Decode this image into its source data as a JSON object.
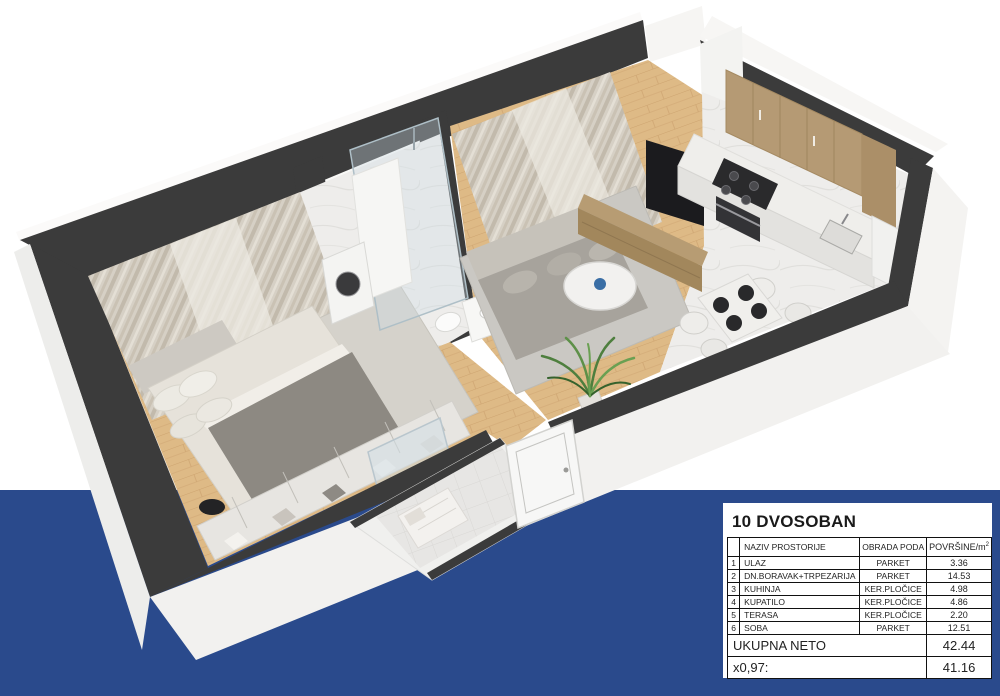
{
  "palette": {
    "background": "#ffffff",
    "band_blue": "#2a4a8c",
    "wall_dark": "#3b3b3b",
    "wood_floor": "#deba86",
    "marble_floor": "#eeedeb",
    "curtain_beige": "#d6d0c5",
    "plant_green": "#4e7f3e",
    "card_bg": "#ffffff",
    "table_border": "#111111"
  },
  "card": {
    "title": "10 DVOSOBAN",
    "header": {
      "num": "",
      "name": "NAZIV PROSTORIJE",
      "floor": "OBRADA PODA",
      "area_base": "POVRŠINE/m",
      "area_sup": "2"
    },
    "rows": [
      {
        "num": "1",
        "name": "ULAZ",
        "floor": "PARKET",
        "area": "3.36"
      },
      {
        "num": "2",
        "name": "DN.BORAVAK+TRPEZARIJA",
        "floor": "PARKET",
        "area": "14.53"
      },
      {
        "num": "3",
        "name": "KUHINJA",
        "floor": "KER.PLOČICE",
        "area": "4.98"
      },
      {
        "num": "4",
        "name": "KUPATILO",
        "floor": "KER.PLOČICE",
        "area": "4.86"
      },
      {
        "num": "5",
        "name": "TERASA",
        "floor": "KER.PLOČICE",
        "area": "2.20"
      },
      {
        "num": "6",
        "name": "SOBA",
        "floor": "PARKET",
        "area": "12.51"
      }
    ],
    "total_label": "UKUPNA NETO",
    "total_value": "42.44",
    "factor_label": "x0,97:",
    "factor_value": "41.16"
  }
}
